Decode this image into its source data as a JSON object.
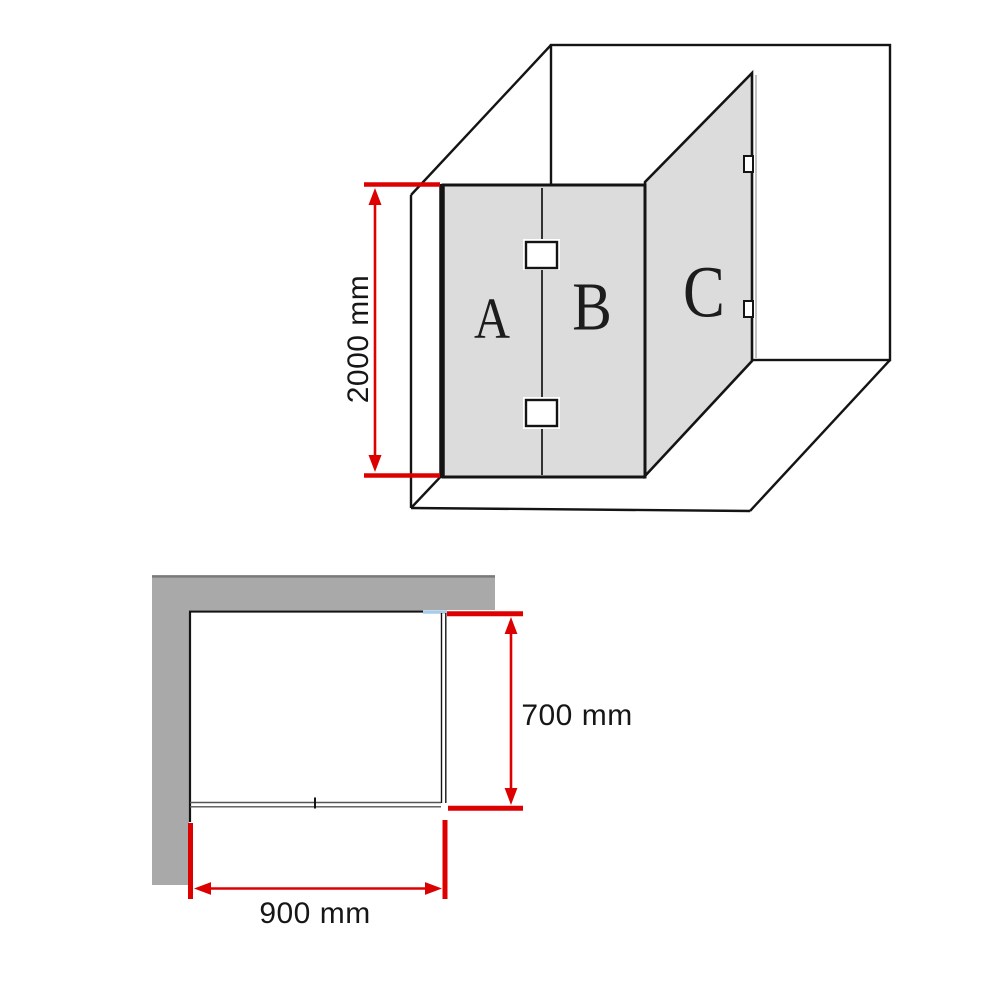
{
  "top_view": {
    "height_label": "2000 mm",
    "panel_labels": {
      "a": "A",
      "b": "B",
      "c": "C"
    }
  },
  "plan_view": {
    "depth_label": "700 mm",
    "width_label": "900 mm"
  },
  "colors": {
    "dimension_red": "#dd0000",
    "glass_fill": "#dcdcdc",
    "wall_fill": "#a9a9a9",
    "wall_edge": "#7a7a7a",
    "glass_seal_blue": "#a9cbe8",
    "line": "#141414"
  }
}
